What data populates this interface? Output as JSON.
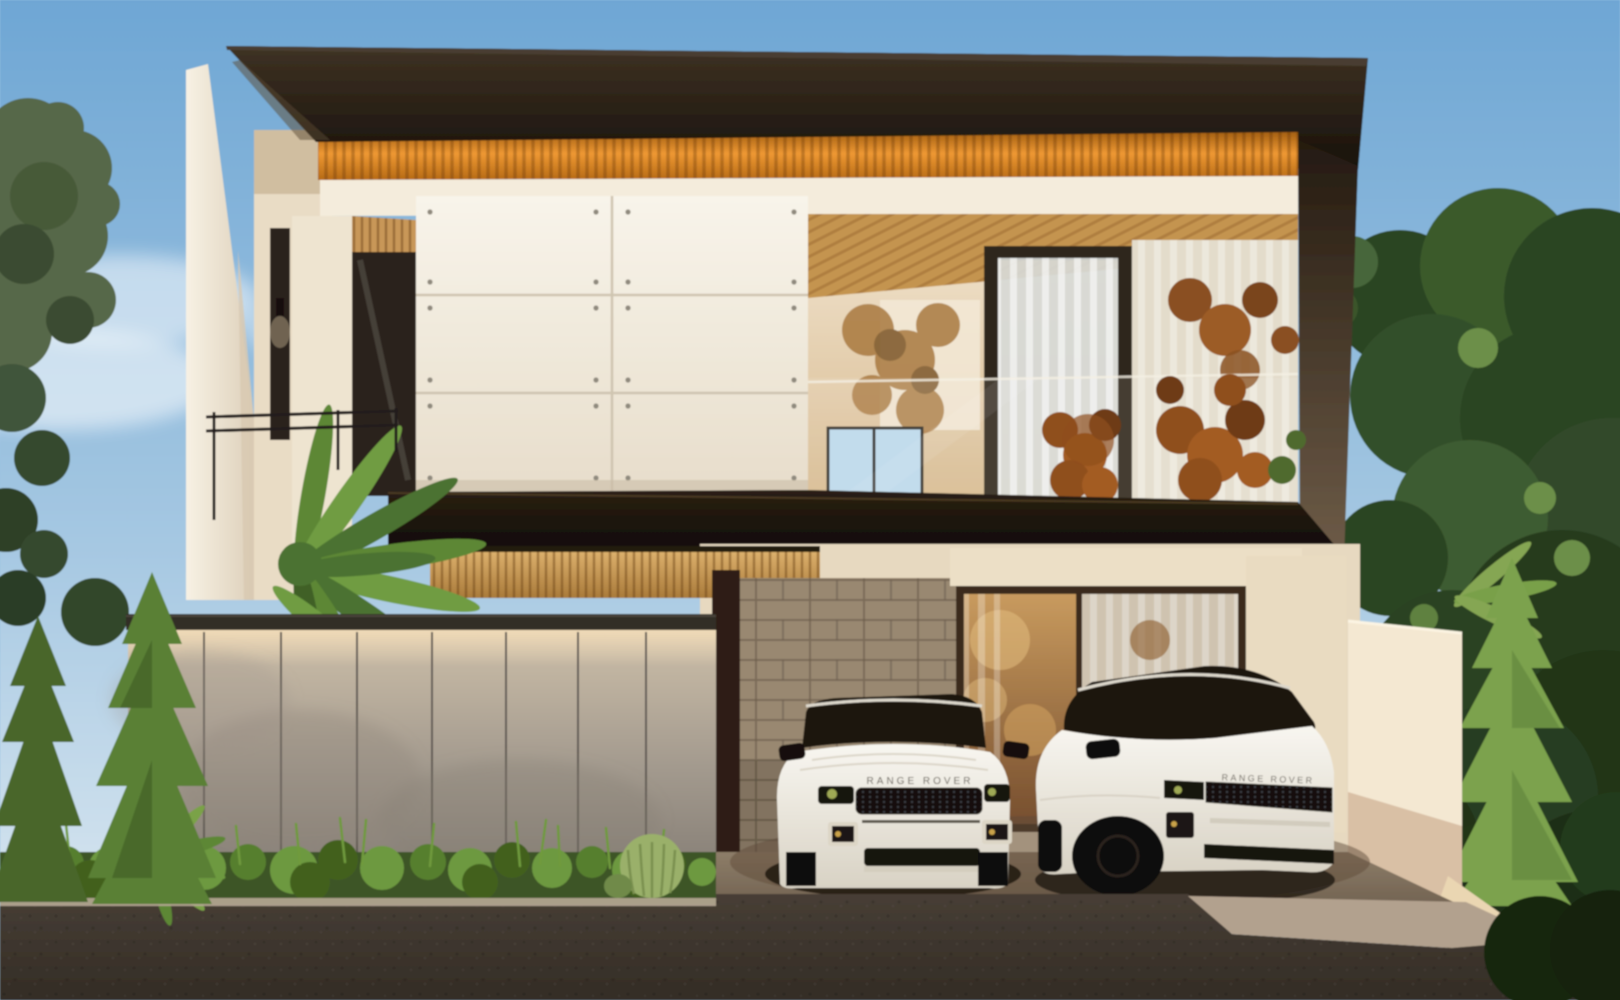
{
  "meta": {
    "title": "Modern villa exterior — architectural render",
    "type": "3d-architectural-visualization",
    "time_of_day": "dusk"
  },
  "scene": {
    "description": "Two-storey modern tropical villa with flat dark overhanging roof, backlit orange timber-slat soffit, white sliding panel facade with exposed fixings, glass balcony with sheer curtains, board concrete boundary wall with cove lighting, stone feature wall at the carport, two white Range Rover Evoque SUVs parked in front, palms and conifers, asphalt street with concrete driveway apron"
  },
  "vehicles": [
    {
      "type": "SUV",
      "color": "white",
      "view": "front",
      "badge": "RANGE ROVER"
    },
    {
      "type": "SUV",
      "color": "white",
      "view": "three-quarter",
      "badge": "RANGE ROVER"
    }
  ],
  "palette": {
    "sky_top": "#6ea6d4",
    "sky_mid": "#a6c8e2",
    "sky_horizon": "#e2ecf2",
    "roof_light": "#3e3223",
    "roof_dark": "#17100a",
    "soffit_orange_deep": "#a35f12",
    "soffit_orange": "#ee9833",
    "wall_white": "#f8f4ea",
    "panel_shadow": "#e7ddcb",
    "wall_cream": "#e9dcc5",
    "wood_slat": "#c4944f",
    "interior_warm": "#d6b88c",
    "fence_top": "#cdbfa9",
    "fence_bottom": "#7e776f",
    "stone": "#998871",
    "glass_warm": "#c89a5e",
    "glass_cool": "#bcd9ea",
    "foliage_dark": "#2c4423",
    "foliage_mid": "#57684a",
    "foliage_light": "#6d9940",
    "conifer": "#5a8034",
    "pine_light": "#7ca24e",
    "car_body": "#f8f6f0",
    "car_body_shade": "#d8d2c4",
    "grille": "#12100c",
    "asphalt": "#473e35",
    "asphalt_deep": "#332c25",
    "driveway": "#b2a18e",
    "carport_floor": "#8d7d68"
  }
}
